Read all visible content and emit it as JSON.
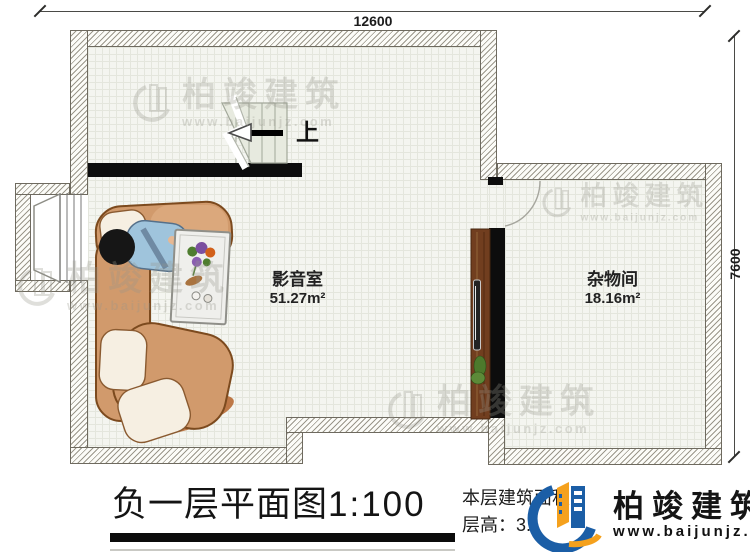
{
  "plan": {
    "dim_top": "12600",
    "dim_right": "7600",
    "stair_up_label": "上",
    "rooms": [
      {
        "name": "影音室",
        "area": "51.27m²"
      },
      {
        "name": "杂物间",
        "area": "18.16m²"
      }
    ]
  },
  "title": {
    "main": "负一层平面图",
    "scale": "1:100"
  },
  "info": {
    "area_label": "本层建筑面积：",
    "height_label": "层高：3."
  },
  "brand": {
    "name": "柏竣建筑",
    "url": "www.baijunjz.com"
  },
  "watermark": {
    "name": "柏竣建筑",
    "url": "www.baijunjz.com"
  },
  "colors": {
    "logo_blue": "#1b5ea6",
    "logo_orange": "#f5a11d",
    "wall_black": "#0d0d0d",
    "floor": "#f4f5f0"
  }
}
